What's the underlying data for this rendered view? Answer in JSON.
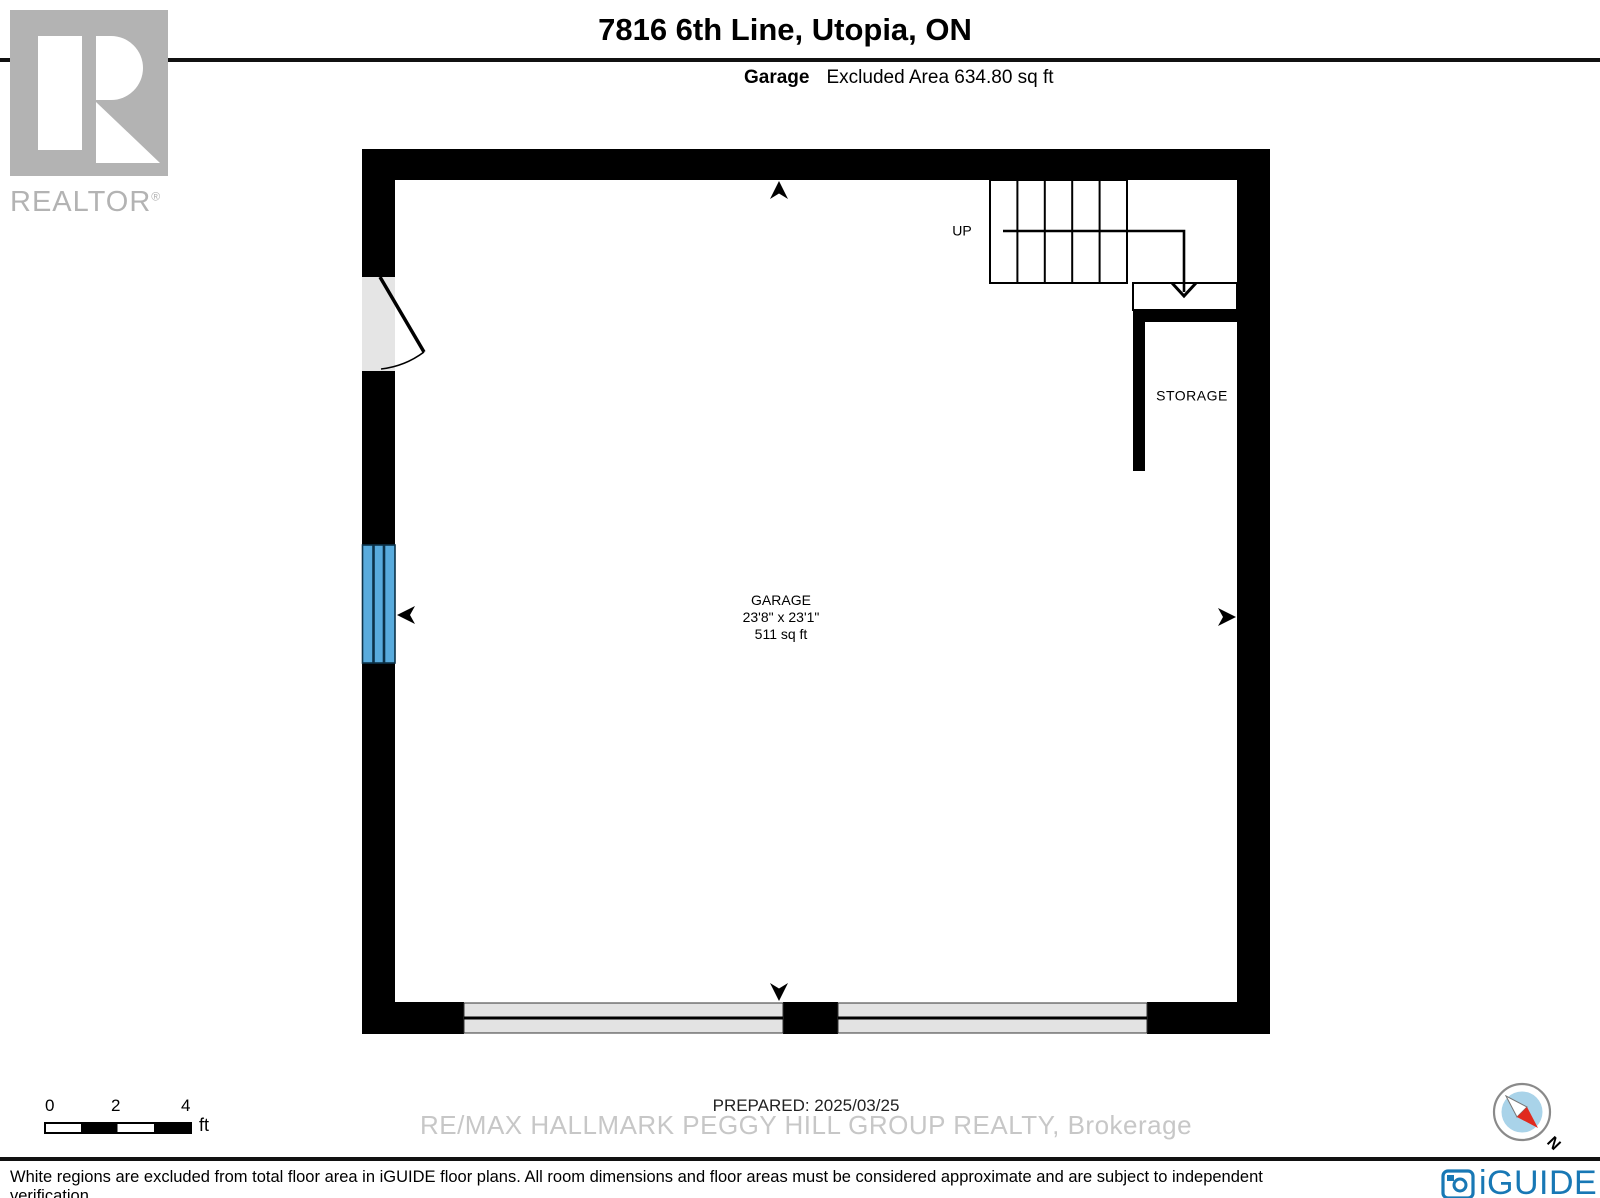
{
  "header": {
    "title": "7816 6th Line, Utopia, ON",
    "room": "Garage",
    "area_note": "Excluded Area 634.80 sq ft"
  },
  "branding": {
    "realtor_wordmark": "REALTOR",
    "registered_mark": "®"
  },
  "plan": {
    "garage": {
      "name": "GARAGE",
      "dimensions": "23'8\" x 23'1\"",
      "area": "511 sq ft"
    },
    "storage": {
      "name": "STORAGE"
    },
    "stairs": {
      "label": "UP"
    }
  },
  "footer": {
    "scale_ticks": [
      "0",
      "2",
      "4"
    ],
    "scale_unit": "ft",
    "prepared": "PREPARED: 2025/03/25",
    "watermark": "RE/MAX HALLMARK PEGGY HILL GROUP REALTY, Brokerage",
    "disclaimer": "White regions are excluded from total floor area in iGUIDE floor plans. All room dimensions and floor areas must be considered approximate and are subject to independent verification.",
    "compass_north": "N",
    "iguide_wordmark": "iGUIDE"
  },
  "colors": {
    "wall": "#000000",
    "opening_gray": "#e5e5e5",
    "window_blue": "#58abdd",
    "watermark_gray": "#c2c2c2",
    "iguide_blue": "#1878b5",
    "compass_blue": "#a9d3e9",
    "compass_red": "#e02a1e"
  }
}
